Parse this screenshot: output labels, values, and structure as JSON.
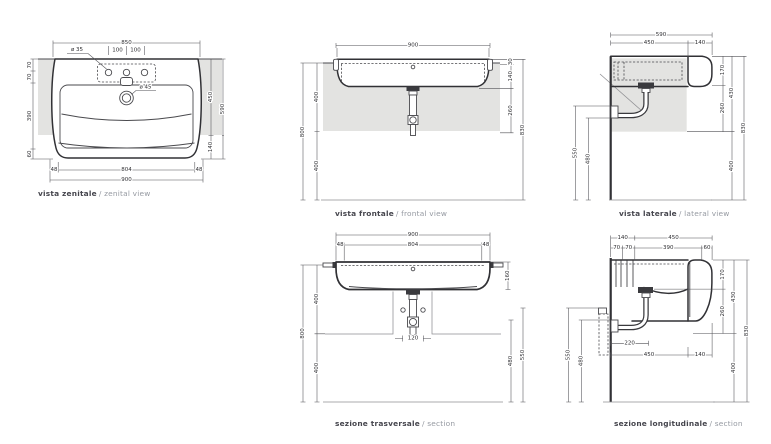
{
  "drawing": {
    "colors": {
      "wall_fill": "#e3e3e1",
      "line": "#313135",
      "caption": "#45454d",
      "caption_light": "#9599a1"
    },
    "zenital": {
      "caption_it": "vista zenitale",
      "caption_en": "/ zenital view",
      "d": {
        "w850": "850",
        "h100a": "100",
        "h100b": "100",
        "dia35": "ø 35",
        "dia45": "ø 45",
        "v70a": "70",
        "v70b": "70",
        "v390": "390",
        "v60": "60",
        "v450": "450",
        "v140": "140",
        "v590": "590",
        "b48a": "48",
        "b804": "804",
        "b48b": "48",
        "b900": "900"
      }
    },
    "frontal": {
      "caption_it": "vista frontale",
      "caption_en": "/ frontal view",
      "d": {
        "w900": "900",
        "v30": "30",
        "v140": "140",
        "v260": "260",
        "v830": "830",
        "v400a": "400",
        "v400b": "400",
        "v800": "800"
      }
    },
    "lateral": {
      "caption_it": "vista laterale",
      "caption_en": "/ lateral view",
      "d": {
        "w590": "590",
        "w450": "450",
        "w140": "140",
        "v170": "170",
        "v430": "430",
        "v260": "260",
        "v830": "830",
        "v400": "400",
        "v550": "550",
        "v480": "480"
      }
    },
    "trasversale": {
      "caption_it": "sezione trasversale",
      "caption_en": "/ section",
      "d": {
        "w900": "900",
        "w48a": "48",
        "w804": "804",
        "w48b": "48",
        "v160": "160",
        "v400a": "400",
        "v400b": "400",
        "v800": "800",
        "w120": "120",
        "v480": "480",
        "v550": "550"
      }
    },
    "longitudinale": {
      "caption_it": "sezione longitudinale",
      "caption_en": "/ section",
      "d": {
        "w140": "140",
        "w450": "450",
        "w70a": "70",
        "w70b": "70",
        "w390": "390",
        "w60": "60",
        "v170": "170",
        "v430": "430",
        "v260": "260",
        "v830": "830",
        "v400": "400",
        "b220": "220",
        "b450": "450",
        "b140": "140",
        "v550": "550",
        "v480": "480"
      }
    }
  }
}
